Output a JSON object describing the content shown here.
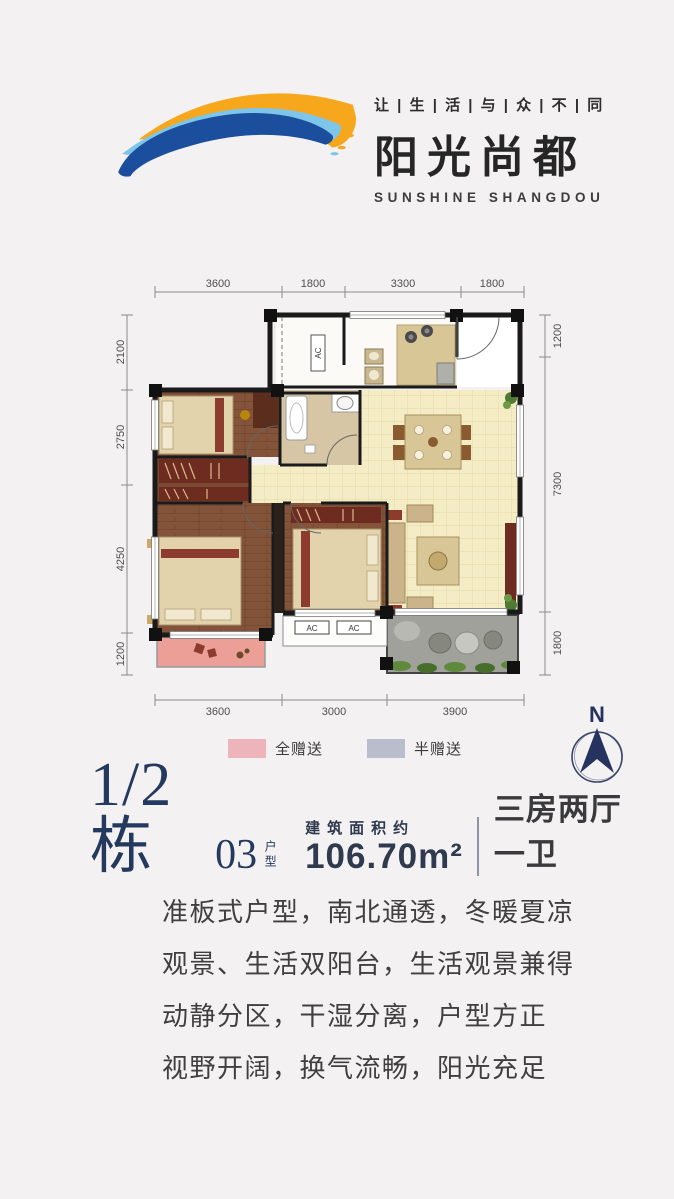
{
  "brand": {
    "tagline": "让 | 生 | 活 | 与 | 众 | 不 | 同",
    "name": "阳光尚都",
    "name_en": "SUNSHINE SHANGDOU"
  },
  "floor_plan": {
    "dimensions": {
      "top": [
        "3600",
        "1800",
        "3300",
        "1800"
      ],
      "left": [
        "2100",
        "2750",
        "4250",
        "1200"
      ],
      "right": [
        "1200",
        "7300",
        "1800"
      ],
      "bottom": [
        "3600",
        "3000",
        "3900"
      ]
    },
    "ac_labels": [
      "AC",
      "AC",
      "AC"
    ],
    "legend": [
      {
        "label": "全赠送",
        "color": "#eeb4bb"
      },
      {
        "label": "半赠送",
        "color": "#b9bdcc"
      }
    ],
    "north_label": "N"
  },
  "unit_info": {
    "block": "1/2栋",
    "unit_number": "03",
    "unit_type_label": "户型",
    "area_label": "建筑面积约",
    "area_value": "106.70m²",
    "layout": "三房两厅一卫"
  },
  "description": {
    "lines": [
      "准板式户型，南北通透，冬暖夏凉",
      "观景、生活双阳台，生活观景兼得",
      "动静分区，干湿分离，户型方正",
      "视野开阔，换气流畅，阳光充足"
    ]
  },
  "colors": {
    "background": "#f3f1f2",
    "logo_orange": "#f6a71c",
    "logo_blue_dark": "#1c4e9e",
    "logo_blue_light": "#7fc4e9",
    "title_navy": "#24395e",
    "wood_floor": "#83543a",
    "tile_floor": "#f4ecc5",
    "bath_floor": "#d7c6a6",
    "balcony_pink": "#ec9f97",
    "balcony_stone": "#a0a19b"
  }
}
